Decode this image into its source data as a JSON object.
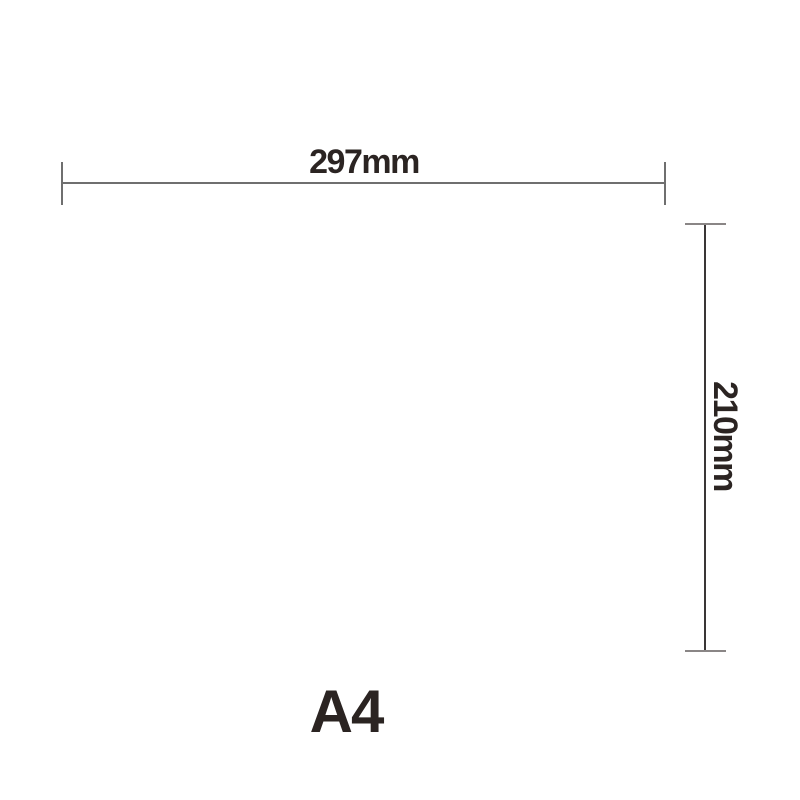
{
  "diagram": {
    "title": "A4 paper size dimension diagram",
    "width_label": "297mm",
    "height_label": "210mm",
    "size_label": "A4",
    "colors": {
      "text": "#2b2422",
      "dim_line": "#6f6f6f",
      "vertical_line": "#3a3636",
      "tick": "#8a8686",
      "background": "#ffffff"
    }
  }
}
